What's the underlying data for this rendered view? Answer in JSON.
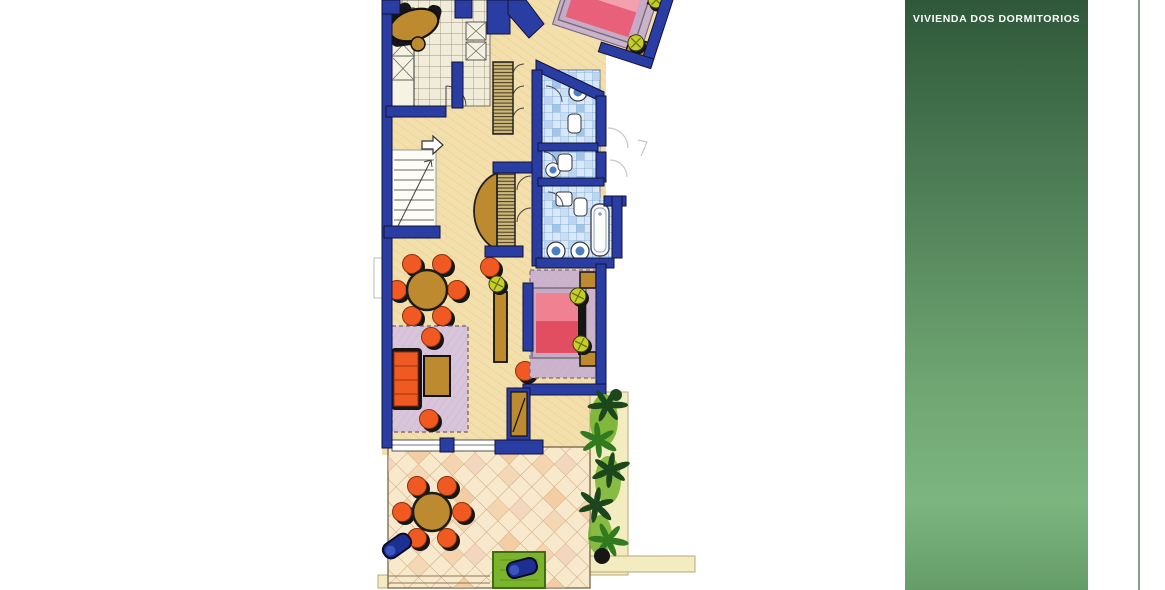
{
  "side_panel": {
    "title": "VIVIENDA DOS DORMITORIOS",
    "gradient": [
      "#2f583a",
      "#3d6a47",
      "#54855b",
      "#6fa572",
      "#7db57f",
      "#659c67"
    ]
  },
  "divider": {
    "color": "#7fa287"
  },
  "colors": {
    "wall": "#2a3da3",
    "wall-edge": "#12123a",
    "floor": "#f3dfab",
    "kitchen-tile": "#f1ecd9",
    "kitchen-line": "#9d987f",
    "bath-tile": "#d9e8f6",
    "bath-line": "#6f9cd2",
    "bath-accent": "#93bce4",
    "bed-pink": "#e9607a",
    "bed-pink-light": "#f4a0ae",
    "bed-red": "#e14e62",
    "bed-red-light": "#ef8190",
    "bed-frame": "#c6abc6",
    "rug-purple": "#d8c5db",
    "rug-lilac": "#cbb3cb",
    "orange": "#f05a22",
    "black": "#161616",
    "wood": "#bd8a2f",
    "yellow-green": "#c6cf2a",
    "terrace": "#f8e8cc",
    "terrace-line": "#c9a87c",
    "terrace-accent1": "#f0c499",
    "terrace-accent2": "#eeb37d",
    "plant-dark": "#1c471c",
    "plant-mid": "#317a1f",
    "plant-light": "#74b32d",
    "mat-green": "#7cb32c",
    "navy-object": "#1d2f90",
    "pale-band": "#f3ecc0",
    "white": "#ffffff"
  }
}
